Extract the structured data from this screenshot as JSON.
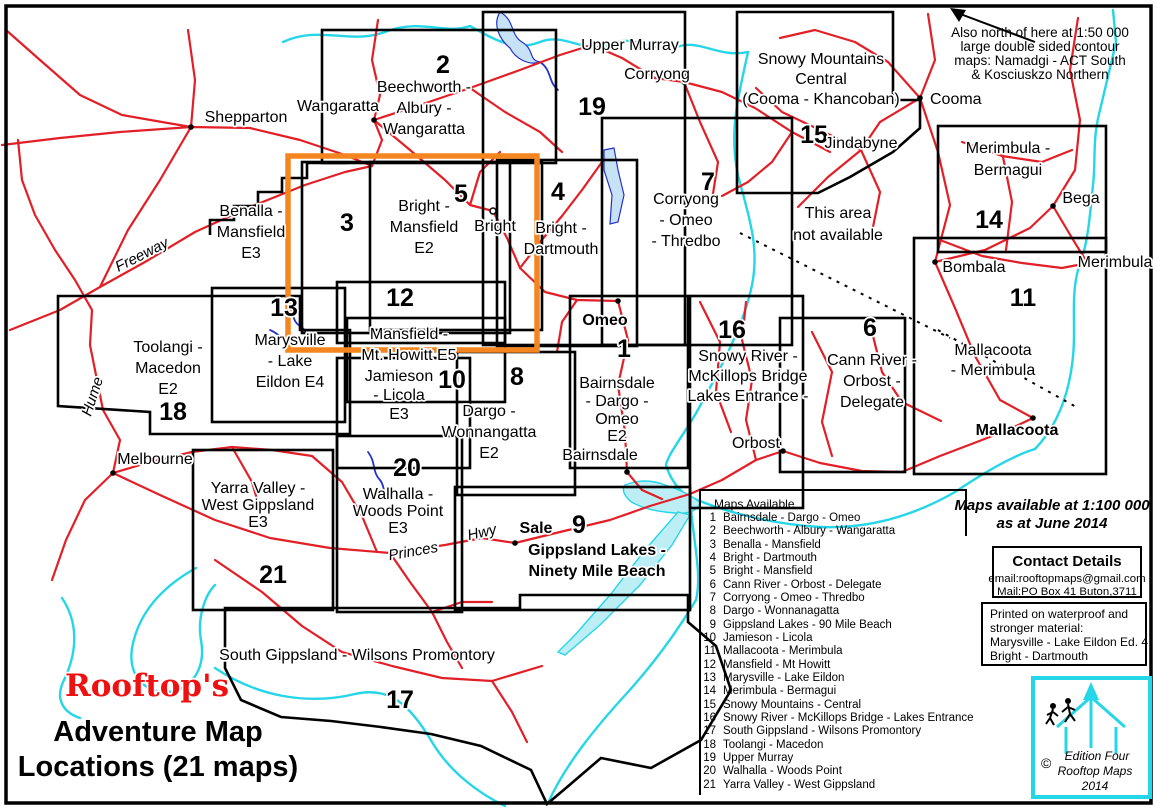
{
  "title": {
    "brand": "Rooftop's",
    "line1": "Adventure Map",
    "line2": "Locations (21 maps)"
  },
  "colors": {
    "road": "#e21f26",
    "water": "#25d6e8",
    "river": "#2233cc",
    "highlight": "#f5861f",
    "brand_red": "#ee1111",
    "lake_fill": "#c8e2f5"
  },
  "regions": [
    {
      "num": "1",
      "lines": [
        "Bairnsdale",
        "- Dargo -",
        "Omeo",
        "E2"
      ]
    },
    {
      "num": "2",
      "lines": [
        "Beechworth -",
        "Albury -",
        "Wangaratta"
      ]
    },
    {
      "num": "3",
      "lines": [
        "Benalla -",
        "Mansfield",
        "E3"
      ]
    },
    {
      "num": "4",
      "lines": [
        "Bright -",
        "Dartmouth"
      ]
    },
    {
      "num": "5",
      "lines": [
        "Bright -",
        "Mansfield",
        "E2"
      ]
    },
    {
      "num": "6",
      "lines": [
        "Cann River -",
        "Orbost -",
        "Delegate"
      ]
    },
    {
      "num": "7",
      "lines": [
        "Corryong",
        "- Omeo",
        "- Thredbo"
      ]
    },
    {
      "num": "8",
      "lines": [
        "Dargo -",
        "Wonnangatta",
        "E2"
      ]
    },
    {
      "num": "9",
      "lines": [
        "Gippsland Lakes -",
        "Ninety Mile Beach"
      ]
    },
    {
      "num": "10",
      "lines": [
        "Jamieson",
        "- Licola",
        "E3"
      ]
    },
    {
      "num": "11",
      "lines": [
        "Mallacoota",
        "- Merimbula"
      ]
    },
    {
      "num": "12",
      "lines": [
        "Mansfield -",
        "Mt. Howitt E5"
      ]
    },
    {
      "num": "13",
      "lines": [
        "Marysville",
        "- Lake",
        "Eildon E4"
      ]
    },
    {
      "num": "14",
      "lines": [
        "Merimbula -",
        "Bermagui"
      ]
    },
    {
      "num": "15",
      "lines": [
        "Snowy Mountains",
        "Central",
        "(Cooma - Khancoban)"
      ]
    },
    {
      "num": "16",
      "lines": [
        "Snowy River -",
        "McKillops Bridge",
        "Lakes Entrance -"
      ]
    },
    {
      "num": "17",
      "lines": [
        "South Gippsland - Wilsons Promontory"
      ]
    },
    {
      "num": "18",
      "lines": [
        "Toolangi -",
        "Macedon",
        "E2"
      ]
    },
    {
      "num": "19",
      "lines": [
        "Upper Murray"
      ]
    },
    {
      "num": "20",
      "lines": [
        "Walhalla -",
        "Woods Point",
        "E3"
      ]
    },
    {
      "num": "21",
      "lines": [
        "Yarra Valley -",
        "West Gippsland",
        "E3"
      ]
    }
  ],
  "unavailable": {
    "lines": [
      "This area",
      "not available"
    ]
  },
  "towns": {
    "shepparton": "Shepparton",
    "wangaratta": "Wangaratta",
    "corryong": "Corryong",
    "cooma": "Cooma",
    "jindabyne": "Jindabyne",
    "bega": "Bega",
    "bombala": "Bombala",
    "merimbula": "Merimbula",
    "mallacoota": "Mallacoota",
    "omeo": "Omeo",
    "bairnsdale": "Bairnsdale",
    "melbourne": "Melbourne",
    "bright": "Bright",
    "sale": "Sale",
    "orbost": "Orbost"
  },
  "road_labels": {
    "hume": "Hume",
    "freeway": "Freeway",
    "princes": "Princes",
    "hwy": "Hwy"
  },
  "north_note": {
    "lines": [
      "Also north of here at 1:50 000",
      "large double sided contour",
      "maps: Namadgi - ACT South",
      "& Kosciuskzo Northern"
    ]
  },
  "availability": {
    "lines": [
      "Maps available at 1:100 000",
      "as at June 2014"
    ]
  },
  "contact": {
    "header": "Contact Details",
    "email": "email:rooftopmaps@gmail.com",
    "mail": "Mail:PO Box 41 Buton,3711"
  },
  "material": {
    "lines": [
      "Printed on waterproof and",
      "stronger material:",
      "Marysville - Lake Eildon Ed. 4",
      "Bright - Dartmouth"
    ]
  },
  "legend": {
    "header": "Maps Available",
    "items": [
      {
        "num": "1",
        "name": "Bairnsdale - Dargo - Omeo"
      },
      {
        "num": "2",
        "name": "Beechworth - Albury - Wangaratta"
      },
      {
        "num": "3",
        "name": "Benalla - Mansfield"
      },
      {
        "num": "4",
        "name": "Bright - Dartmouth"
      },
      {
        "num": "5",
        "name": "Bright - Mansfield"
      },
      {
        "num": "6",
        "name": "Cann River - Orbost - Delegate"
      },
      {
        "num": "7",
        "name": "Corryong - Omeo - Thredbo"
      },
      {
        "num": "8",
        "name": "Dargo - Wonnanagatta"
      },
      {
        "num": "9",
        "name": "Gippsland Lakes - 90 Mile Beach"
      },
      {
        "num": "10",
        "name": "Jamieson - Licola"
      },
      {
        "num": "11",
        "name": "Mallacoota - Merimbula"
      },
      {
        "num": "12",
        "name": "Mansfield - Mt Howitt"
      },
      {
        "num": "13",
        "name": "Marysville - Lake Eildon"
      },
      {
        "num": "14",
        "name": "Merimbula - Bermagui"
      },
      {
        "num": "15",
        "name": "Snowy Mountains - Central"
      },
      {
        "num": "16",
        "name": "Snowy River - McKillops  Bridge - Lakes Entrance"
      },
      {
        "num": "17",
        "name": "South Gippsland - Wilsons  Promontory"
      },
      {
        "num": "18",
        "name": "Toolangi - Macedon"
      },
      {
        "num": "19",
        "name": "Upper Murray"
      },
      {
        "num": "20",
        "name": "Walhalla - Woods Point"
      },
      {
        "num": "21",
        "name": "Yarra Valley - West Gippsland"
      }
    ]
  },
  "logo": {
    "copyright": "©",
    "lines": [
      "Edition Four",
      "Rooftop Maps",
      "2014"
    ]
  }
}
